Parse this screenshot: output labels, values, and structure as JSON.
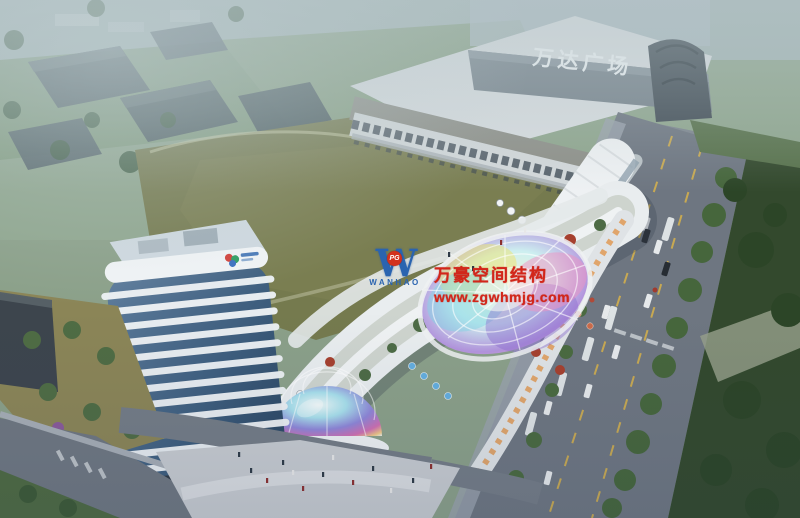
{
  "scene": {
    "mall_sign": "万达广场"
  },
  "watermark": {
    "monogram": "W",
    "badge": "PG",
    "name": "WANHAO",
    "line1": "万豪空间结构",
    "line2": "www.zgwhmjg.com",
    "text_color": "#d3261a",
    "logo_color": "#2a64b0"
  },
  "colors": {
    "haze": "#b7c6ca",
    "field_green": "#757a4e",
    "road_gray": "#6e7681",
    "mall_facade": "#76828b",
    "tower_white": "#edf1f4",
    "tower_glass": "#3e5e7e",
    "lawn_dark": "#33492d",
    "warm_glow": "#e8a35f",
    "canopy_palette": [
      "#f0e46e",
      "#7fd4e4",
      "#8f6fd0",
      "#ef92c2",
      "#f6f8f2"
    ]
  }
}
